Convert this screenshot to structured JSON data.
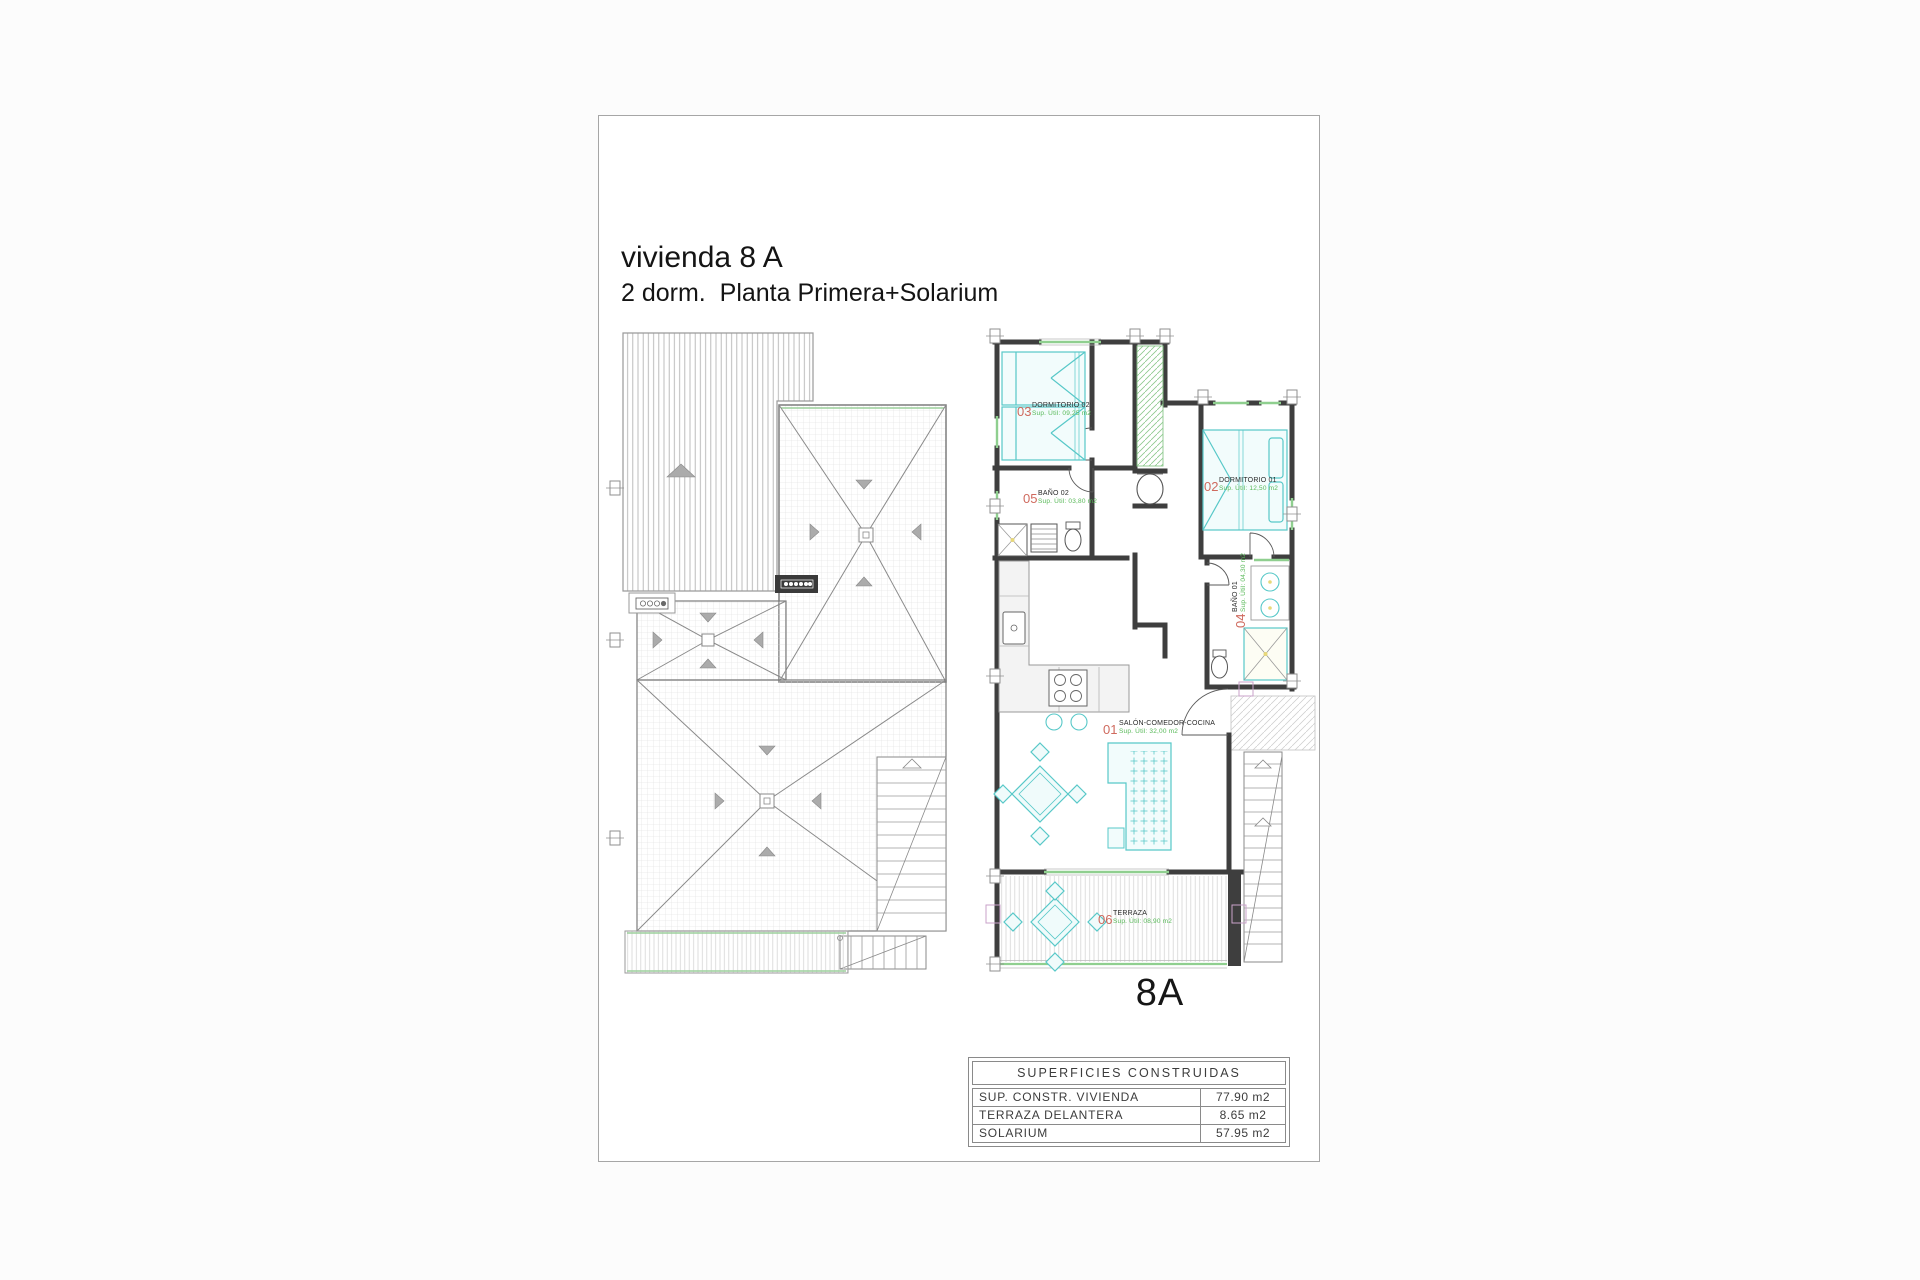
{
  "page": {
    "title": "vivienda 8 A",
    "subtitle": "2 dorm.  Planta Primera+Solarium",
    "unit_label": "8A"
  },
  "rooms": [
    {
      "num": "01",
      "name": "SALÓN-COMEDOR-COCINA",
      "sup": "Sup. Útil: 32,00 m2"
    },
    {
      "num": "02",
      "name": "DORMITORIO 01",
      "sup": "Sup. Útil: 12,50 m2"
    },
    {
      "num": "03",
      "name": "DORMITORIO 02",
      "sup": "Sup. Útil: 09,25 m2"
    },
    {
      "num": "04",
      "name": "BAÑO 01",
      "sup": "Sup. Útil: 04,30 m2"
    },
    {
      "num": "05",
      "name": "BAÑO 02",
      "sup": "Sup. Útil: 03,80 m2"
    },
    {
      "num": "06",
      "name": "TERRAZA",
      "sup": "Sup. Útil: 08,90 m2"
    }
  ],
  "areas_table": {
    "header": "SUPERFICIES CONSTRUIDAS",
    "rows": [
      {
        "label": "SUP. CONSTR. VIVIENDA",
        "value": "77.90 m2"
      },
      {
        "label": "TERRAZA DELANTERA",
        "value": "8.65 m2"
      },
      {
        "label": "SOLARIUM",
        "value": "57.95 m2"
      }
    ]
  },
  "colors": {
    "wall": "#3e3e3e",
    "furniture": "#57c8c8",
    "window": "#8fcf8f",
    "label_number": "#cf6a5e",
    "label_area": "#56b856"
  }
}
